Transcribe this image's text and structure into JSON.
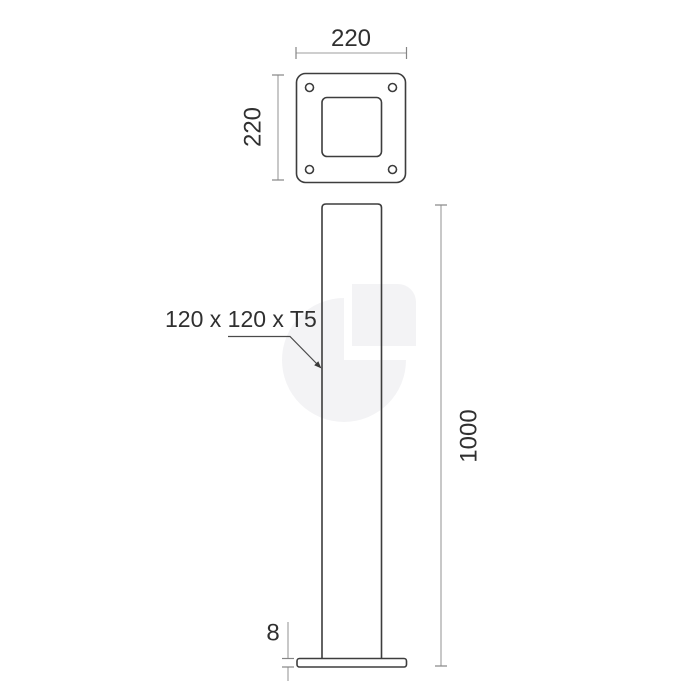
{
  "drawing": {
    "kind": "technical-dimension-drawing",
    "views": [
      "top-view-base-plate",
      "front-view-post"
    ]
  },
  "labels": {
    "plate_width": "220",
    "plate_depth": "220",
    "post_profile": "120 x 120 x T5",
    "overall_height": "1000",
    "base_thickness": "8"
  },
  "colors": {
    "background": "#ffffff",
    "outline": "#3d3d3d",
    "dimension_line": "#9c9c9c",
    "text": "#303030",
    "watermark": "#f3f3f5"
  }
}
